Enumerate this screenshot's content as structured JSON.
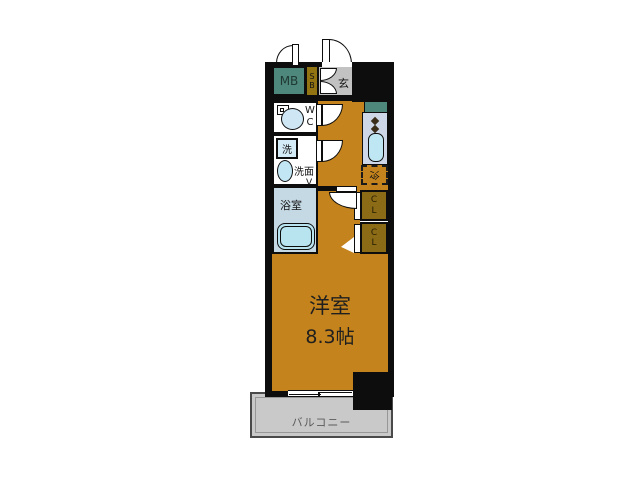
{
  "meta": {
    "type": "floor-plan",
    "layout_name": "1K apartment floor plan"
  },
  "labels": {
    "meter_box": "MB",
    "shoe_box": "S\nB",
    "entrance": "玄",
    "wc": "W\nC",
    "washer": "洗",
    "washroom": "洗面",
    "bathroom": "浴室",
    "door_mark": "V",
    "fridge": "冷",
    "closet": "C\nL",
    "room_name": "洋室",
    "room_size": "8.3帖",
    "balcony": "バルコニー"
  },
  "colors": {
    "wall_black": "#0d0d0d",
    "floor_orange": "#c4831c",
    "meter_box_teal": "#4e877c",
    "kitchen_counter_teal": "#4e877c",
    "shoe_box_olive": "#937413",
    "closet_olive": "#8c6b16",
    "entrance_gray": "#c2c2c2",
    "bathroom_blue": "#c5d9e5",
    "fixture_light_blue": "#bfe7f3",
    "kitchen_unit_lavender": "#cdd7e7",
    "balcony_gray": "#c9c9c9"
  }
}
